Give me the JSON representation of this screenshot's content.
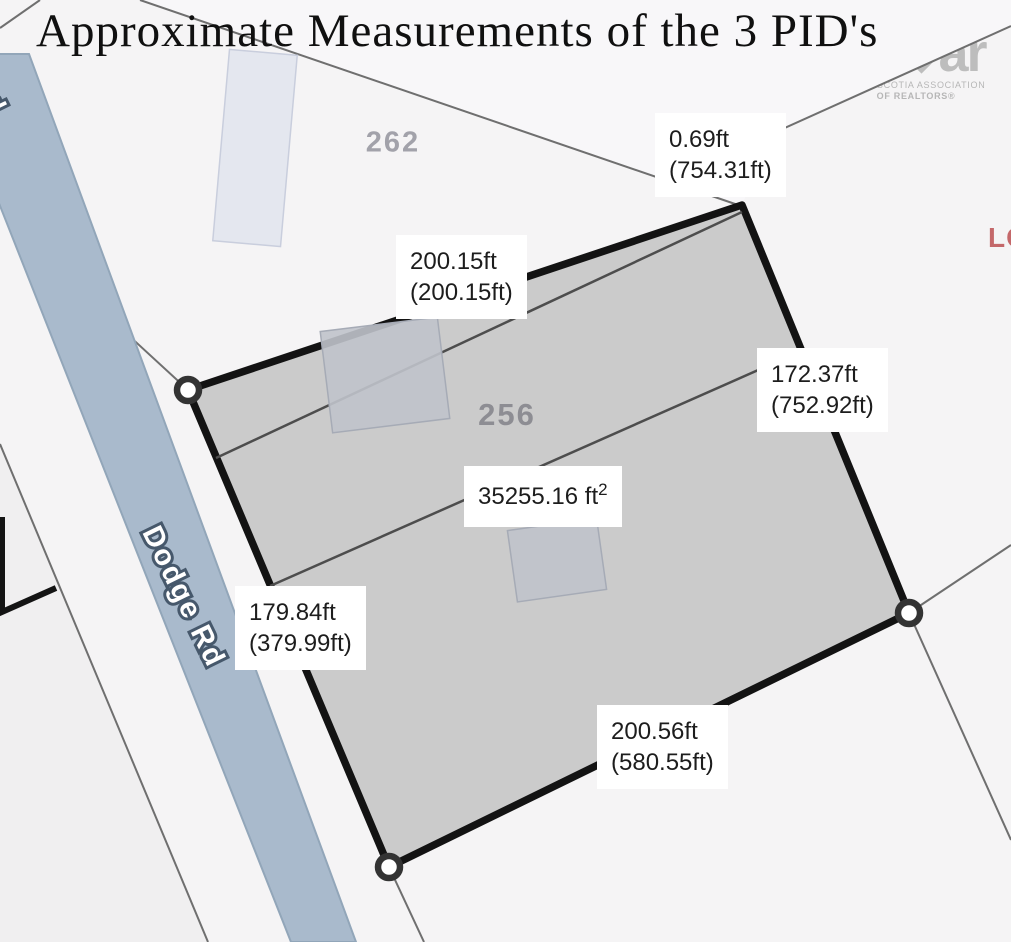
{
  "title": "Approximate Measurements of the 3 PID's",
  "logo": {
    "left": "ns",
    "right": "ar",
    "sub1": "NOVA SCOTIA ASSOCIATION",
    "sub2": "OF REALTORS®"
  },
  "map": {
    "road_name": "Dodge Rd",
    "road_fragment": "d",
    "parcel_numbers": {
      "upper": "262",
      "main": "256"
    },
    "partial_text": "LO",
    "measurements": [
      {
        "id": "top",
        "line1": "0.69ft",
        "line2": "(754.31ft)"
      },
      {
        "id": "upper-left",
        "line1": "200.15ft",
        "line2": "(200.15ft)"
      },
      {
        "id": "right",
        "line1": "172.37ft",
        "line2": "(752.92ft)"
      },
      {
        "id": "left",
        "line1": "179.84ft",
        "line2": "(379.99ft)"
      },
      {
        "id": "bottom",
        "line1": "200.56ft",
        "line2": "(580.55ft)"
      }
    ],
    "area": {
      "value": "35255.16 ft",
      "sup": "2"
    },
    "colors": {
      "parcel_fill": "#c9c9c9",
      "parcel_stroke": "#131313",
      "road_fill": "#a9bacc",
      "label_bg": "#ffffff",
      "accent_red": "#c4686a"
    }
  }
}
